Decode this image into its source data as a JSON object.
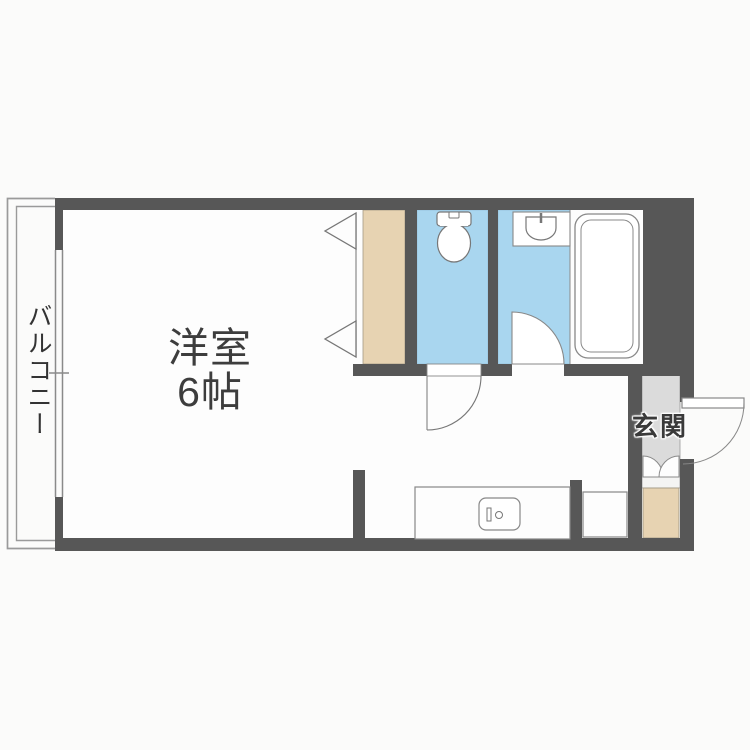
{
  "page": {
    "background": "#fbfbfa"
  },
  "floorplan": {
    "labels": {
      "main_room_name": "洋室",
      "main_room_size": "6帖",
      "balcony": "バルコニー",
      "entrance": "玄関"
    },
    "colors": {
      "wall": "#575757",
      "wet_area_blue": "#a9d6ef",
      "closet_beige": "#e7d3b2",
      "entry_floor_gray": "#dbdbdb",
      "entry_step_white": "#f4f4f3",
      "floor_white": "#fdfdfd",
      "outline_gray": "#8a8a8a",
      "label_text": "#3e3e3e"
    },
    "fixtures": [
      "sliding-window",
      "closet-bifold-doors",
      "toilet",
      "washbasin",
      "bathtub",
      "bathroom-door",
      "toilet-door",
      "entrance-door",
      "entry-curtain-doors",
      "kitchen-counter",
      "kitchen-sink",
      "washer-space",
      "shoe-cabinet"
    ]
  }
}
